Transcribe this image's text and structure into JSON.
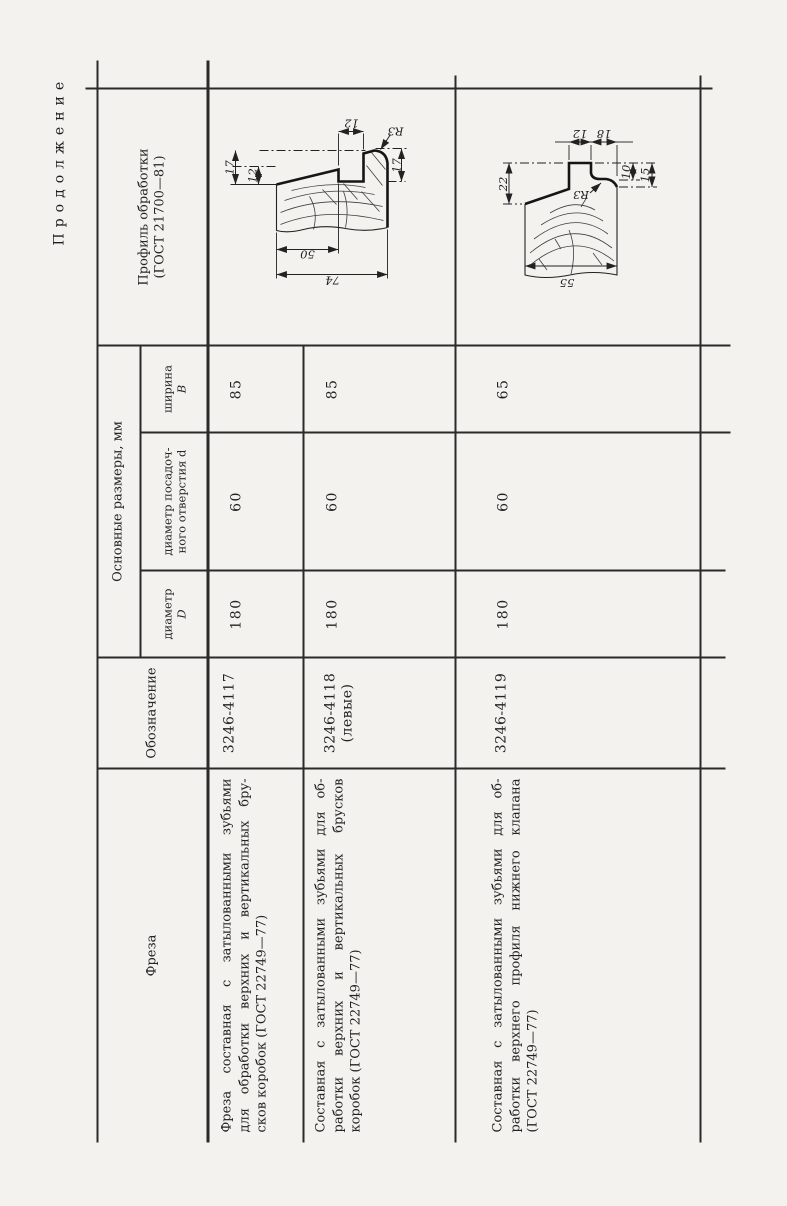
{
  "page": {
    "continuation_label": "Продолжение"
  },
  "table": {
    "headers": {
      "tool": "Фреза",
      "designation": "Обозначение",
      "dimensions_group": "Основные размеры, мм",
      "dim_diameter_l1": "диаметр",
      "dim_diameter_l2": "D",
      "dim_bore_l1": "диаметр посадоч-",
      "dim_bore_l2": "ного отверстия d",
      "dim_width_l1": "ширина",
      "dim_width_l2": "В",
      "profile_l1": "Профиль обработки",
      "profile_l2": "(ГОСТ 21700—81)"
    },
    "rows": [
      {
        "lines": [
          "Фреза составная с затылованными зубьями",
          "для обработки верхних и вертикальных бру-",
          "сков коробок (ГОСТ 22749—77)"
        ],
        "designation": "3246-4117",
        "designation_note": "",
        "D": "180",
        "d": "60",
        "B": "85"
      },
      {
        "lines": [
          "Составная с затылованными зубьями для об-",
          "работки верхних и вертикальных брусков",
          "коробок (ГОСТ 22749—77)"
        ],
        "designation": "3246-4118",
        "designation_note": "(левые)",
        "D": "180",
        "d": "60",
        "B": "85"
      },
      {
        "lines": [
          "Составная с затылованными зубьями для об-",
          "работки верхнего профиля нижнего клапана",
          "(ГОСТ 22749—77)"
        ],
        "designation": "3246-4119",
        "designation_note": "",
        "D": "180",
        "d": "60",
        "B": "65"
      }
    ],
    "profiles": [
      {
        "dims": {
          "left_outer": "17",
          "left_inner": "12",
          "top": "12",
          "radius": "R3",
          "right": "17",
          "bottom_inner": "50",
          "bottom_outer": "74"
        }
      },
      {
        "dims": {
          "left": "22",
          "top_left": "12",
          "top_right": "18",
          "right_inner": "10",
          "right_outer": "15",
          "radius": "R3",
          "bottom": "55"
        }
      }
    ]
  }
}
